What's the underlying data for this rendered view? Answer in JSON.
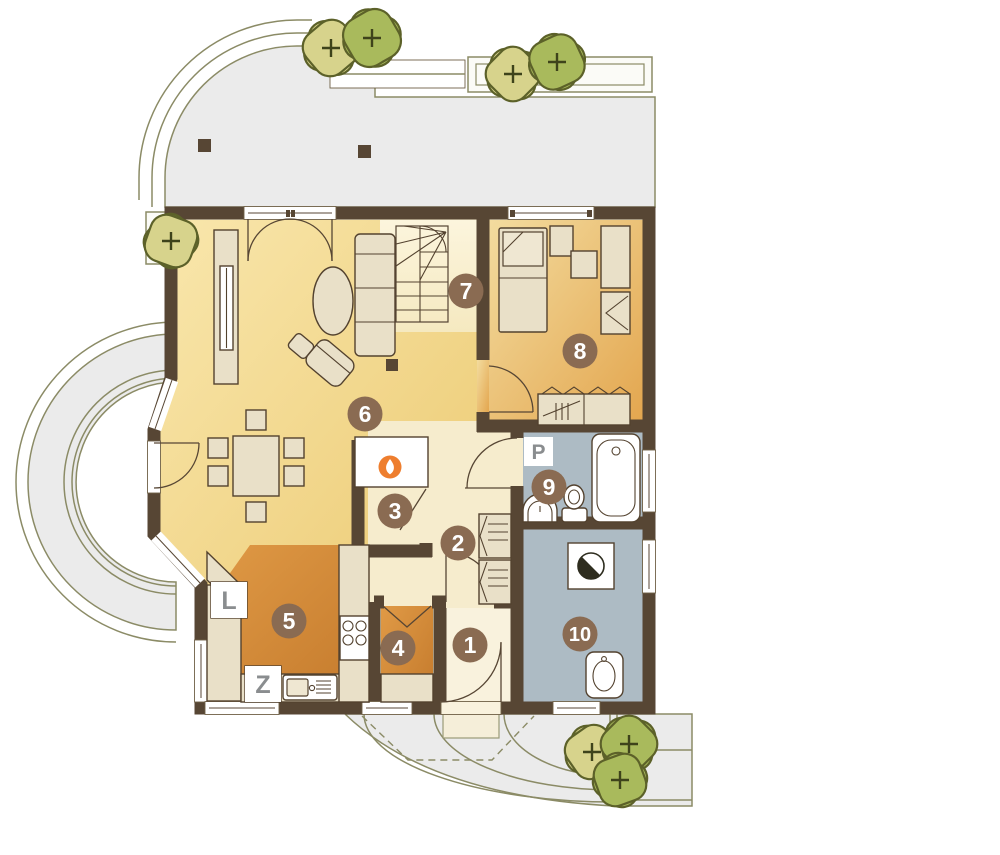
{
  "plan_type": "architectural floor plan, ground floor",
  "rooms": [
    {
      "id": "room-1",
      "label": "1"
    },
    {
      "id": "room-2",
      "label": "2"
    },
    {
      "id": "room-3",
      "label": "3"
    },
    {
      "id": "room-4",
      "label": "4"
    },
    {
      "id": "room-5",
      "label": "5"
    },
    {
      "id": "room-6",
      "label": "6"
    },
    {
      "id": "room-7",
      "label": "7"
    },
    {
      "id": "room-8",
      "label": "8"
    },
    {
      "id": "room-9",
      "label": "9"
    },
    {
      "id": "room-10",
      "label": "10"
    }
  ],
  "markers": [
    {
      "id": "marker-L",
      "label": "L"
    },
    {
      "id": "marker-Z",
      "label": "Z"
    },
    {
      "id": "marker-P",
      "label": "P"
    }
  ],
  "icons": [
    {
      "name": "flame-icon",
      "meaning": "fireplace"
    },
    {
      "name": "boiler-icon",
      "meaning": "boiler half-circle symbol"
    },
    {
      "name": "bush-icon",
      "meaning": "shrub with plus mark"
    }
  ],
  "colors": {
    "wall": "#574634",
    "living_floor_light": "#f9e7ad",
    "living_floor_dark": "#ecca72",
    "kitchen_floor_light": "#e09a46",
    "kitchen_floor_dark": "#c47a2c",
    "bedroom_floor_light": "#f3dc9f",
    "bedroom_floor_dark": "#e3a64f",
    "bath_floor": "#adbbc4",
    "hall_floor": "#f6eccd",
    "stairs_floor": "#fbf3d9",
    "entry_floor": "#f9f2dd",
    "furniture": "#e9e0c8",
    "terrace": "#ebebeb",
    "landscape_line": "#8b8b66",
    "bush_light": "#d7d38c",
    "bush_dark": "#a9ba5c",
    "badge_brown": "#8a6b52",
    "letter_gray": "#8a8d8f",
    "flame_orange": "#ee7e2e"
  }
}
